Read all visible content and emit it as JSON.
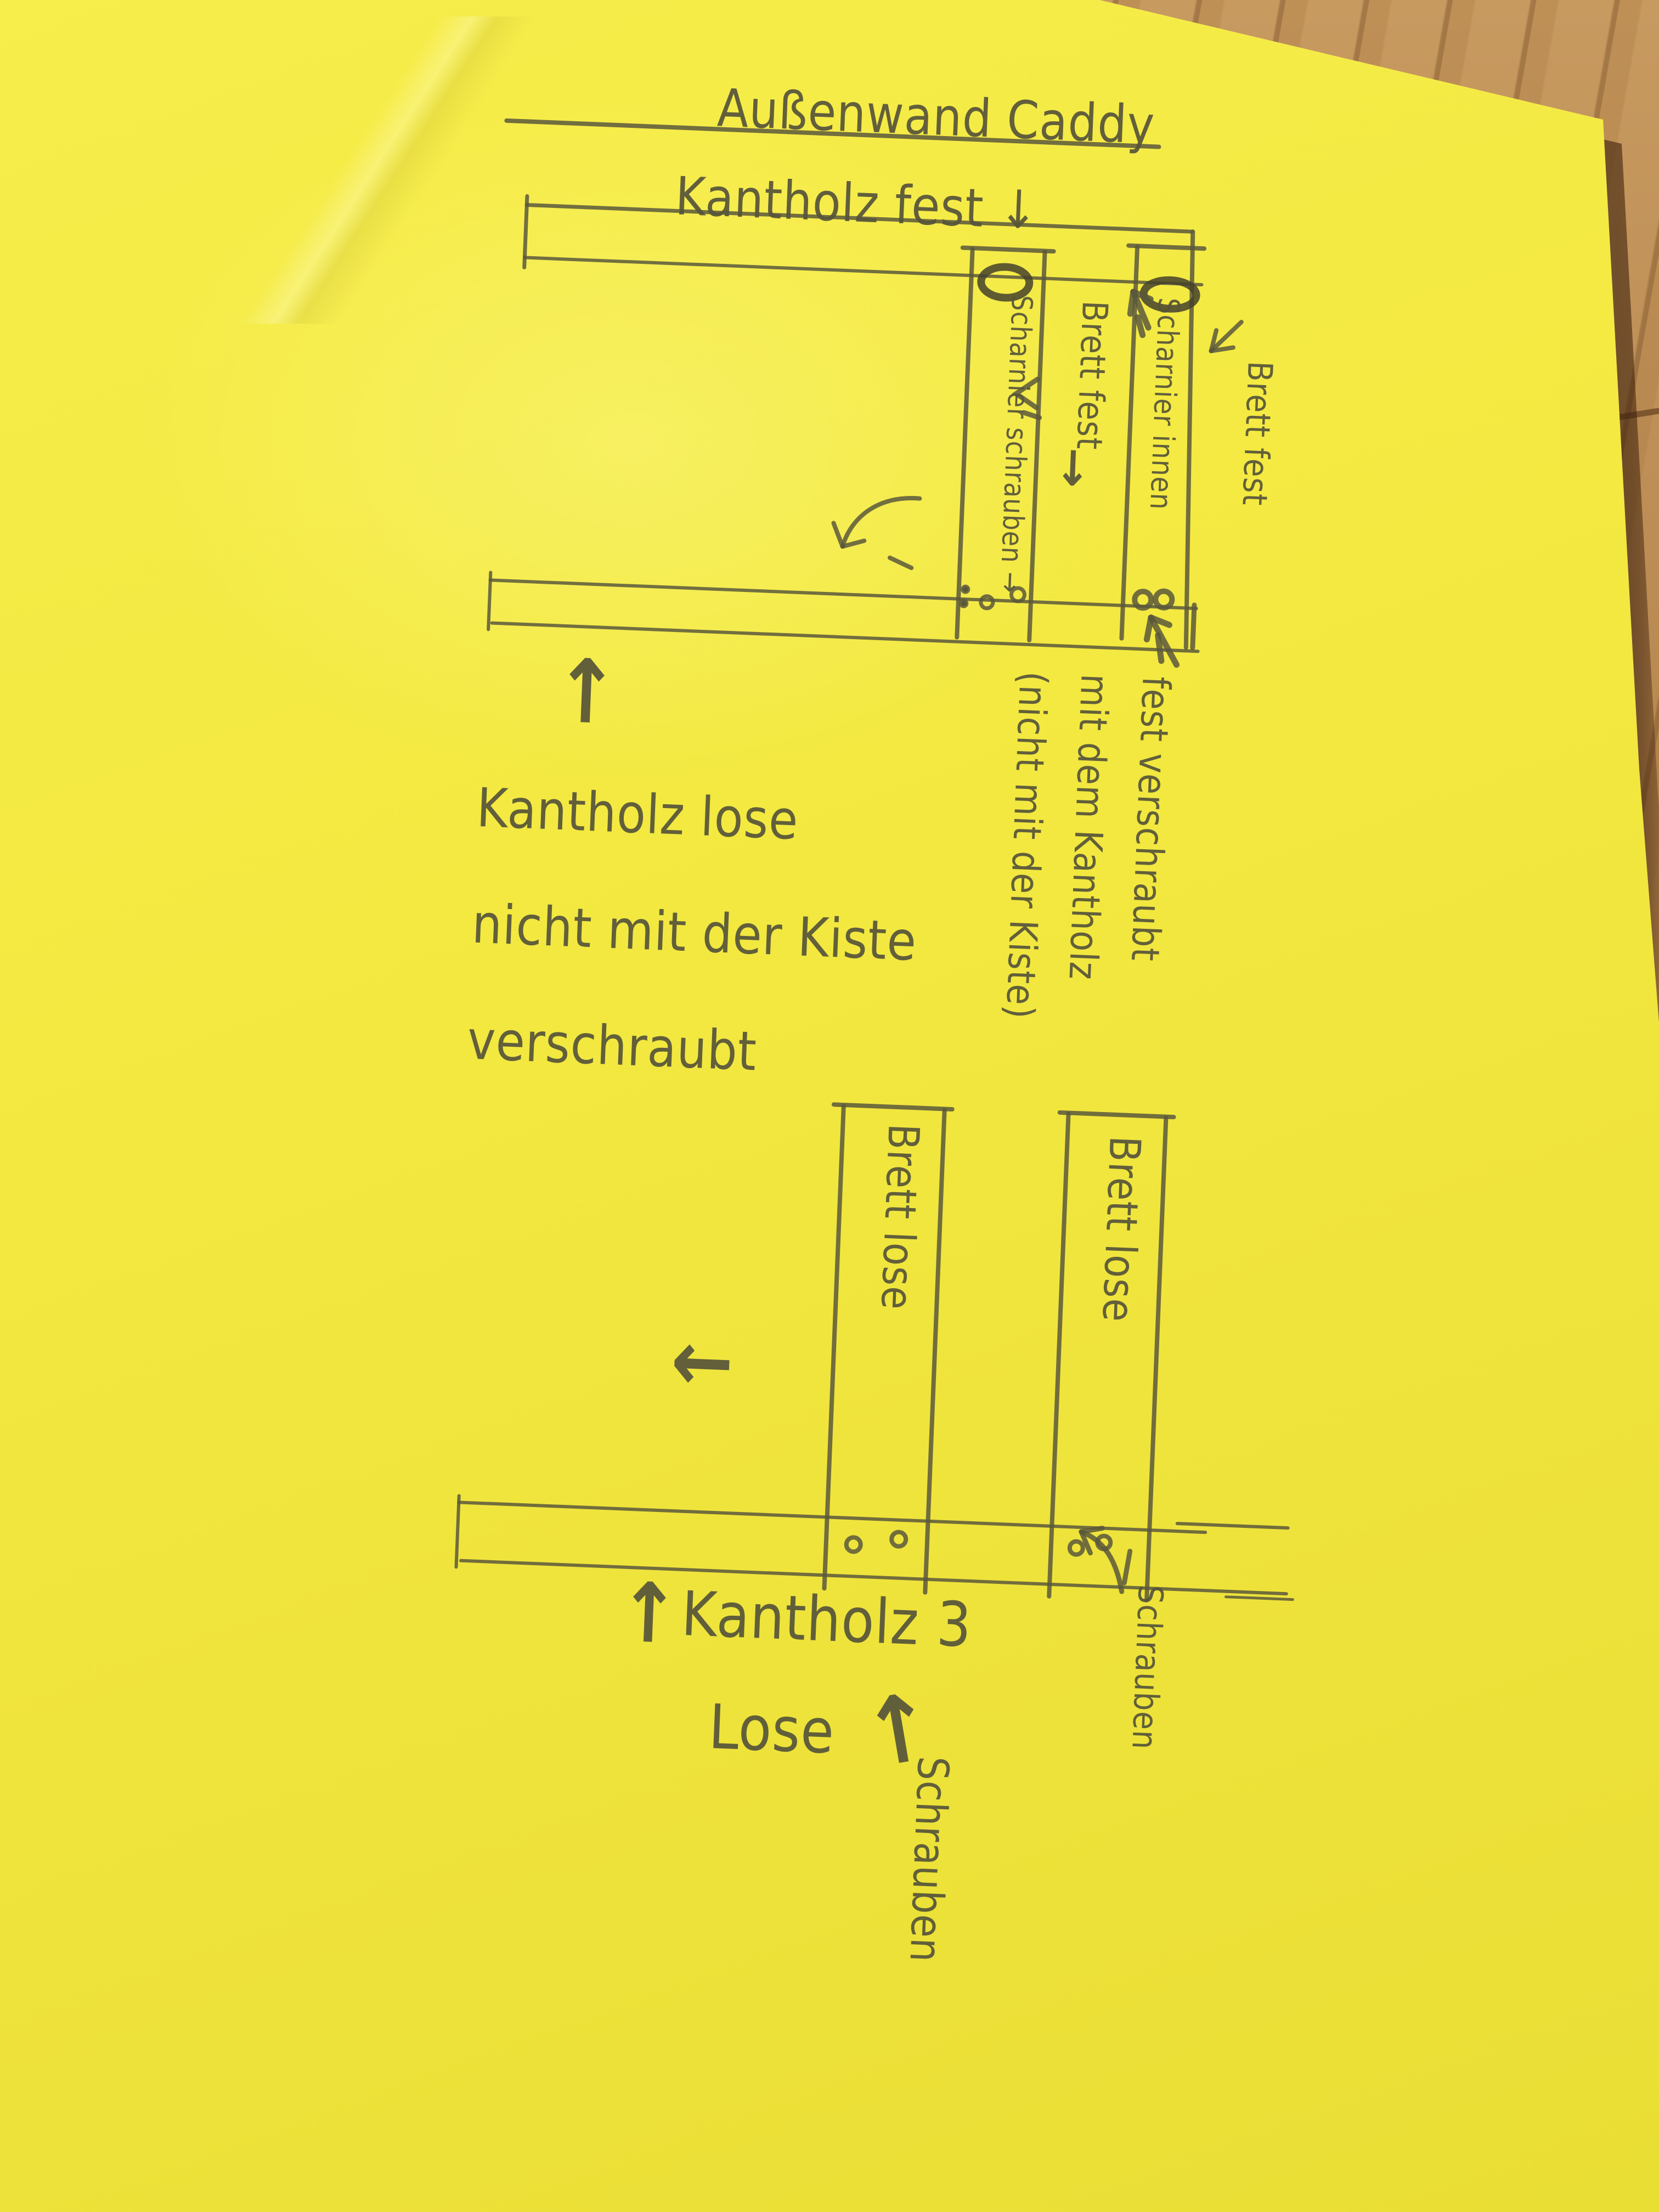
{
  "colors": {
    "paper": "#f3e941",
    "wood": "#b5854e",
    "pencil": "#56543a"
  },
  "title": {
    "text": "Außenwand Caddy"
  },
  "top_diagram": {
    "kantholz_fest_label": "Kantholz fest ↓",
    "left_board_label": "Scharnier schrauben →",
    "mid_board_label": "Brett fest",
    "mid_board_arrow": "↓",
    "right_board_label": "Scharnier innen",
    "outer_board_label": "Brett fest",
    "lose_note_arrow": "↑",
    "lose_note_lines": [
      "Kantholz lose",
      "nicht mit der Kiste",
      "verschraubt"
    ],
    "fest_note_lines": [
      "fest verschraubt",
      "mit dem Kantholz",
      "(nicht mit der Kiste)"
    ]
  },
  "bottom_diagram": {
    "left_board_label": "Brett lose",
    "right_board_label": "Brett lose",
    "pointer_arrow": "←",
    "kantholz_arrow": "↑",
    "kantholz_label": "Kantholz 3",
    "lose_label": "Lose",
    "lose_arrow": "↑",
    "schrauben_mid_label": "Schrauben",
    "schrauben_right_label": "Schrauben"
  }
}
